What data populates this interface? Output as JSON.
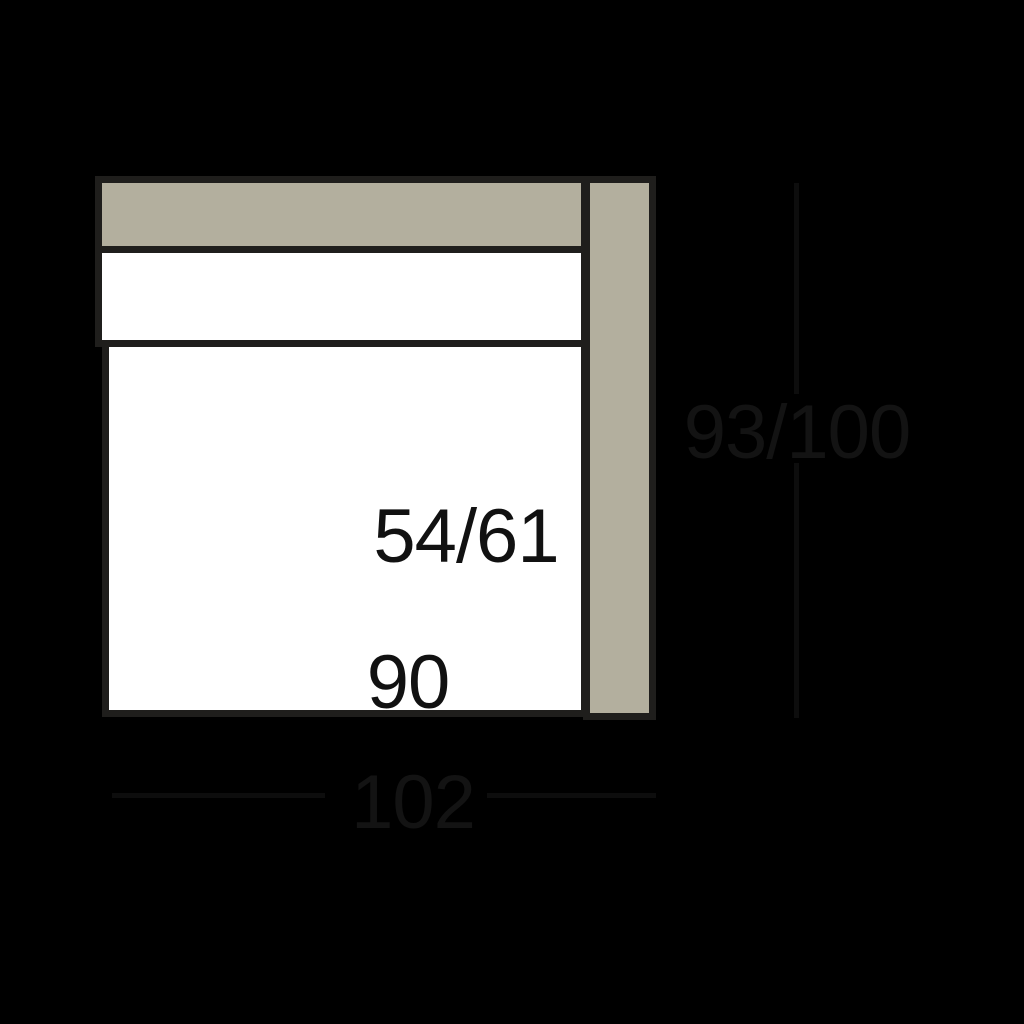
{
  "diagram": {
    "dimensions": {
      "seat_depth_label": "54/61",
      "seat_width_label": "90",
      "overall_width_label": "102",
      "overall_depth_label": "93/100"
    },
    "colors": {
      "background": "#000000",
      "upholstery_fill": "#b3af9e",
      "cushion_fill": "#ffffff",
      "outline_stroke": "#1f1e1c",
      "dimension_line": "#0d0d0d",
      "dimension_text": "#131313",
      "interior_text": "#111111"
    }
  }
}
